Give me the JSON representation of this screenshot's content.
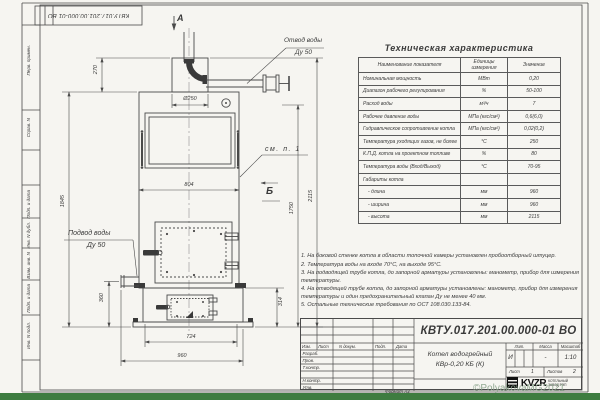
{
  "meta": {
    "stamp_rotated": "КВТУ.017.201.00.000-01 ВО",
    "format_label": "Формат А3",
    "watermark": "©PolyakovaMG2021",
    "colors": {
      "footer_green": "#3e7c40",
      "paper": "#f6f5f1",
      "line": "#4a4a4a"
    }
  },
  "frame_fields": [
    "Перв. примен.",
    "Справ. N",
    "Подп. и дата",
    "Инв. N дубл.",
    "Взам. инв. N",
    "Подп. и дата",
    "Инв. N подл."
  ],
  "drawing": {
    "section_a": "А",
    "view_b": "Б",
    "see_note": "см. п. 1",
    "outlet_label_1": "Отвод воды",
    "outlet_label_2": "Ду 50",
    "inlet_label_1": "Подвод воды",
    "inlet_label_2": "Ду 50",
    "dims": {
      "d270": "270",
      "d250": "Ø250",
      "d804": "804",
      "d1845": "1845",
      "d360": "360",
      "d724": "724",
      "d960": "960",
      "d314": "314",
      "d1750": "1750",
      "d2115": "2115"
    }
  },
  "spec_table": {
    "title": "Техническая характеристика",
    "headers": [
      "Наименование показателя",
      "Единицы измерения",
      "Значение"
    ],
    "rows": [
      {
        "name": "Номинальная мощность",
        "unit": "МВт",
        "value": "0,20"
      },
      {
        "name": "Диапазон рабочего регулирования",
        "unit": "%",
        "value": "50-100"
      },
      {
        "name": "Расход воды",
        "unit": "м³/ч",
        "value": "7"
      },
      {
        "name": "Рабочее давление воды",
        "unit": "МПа (кгс/см²)",
        "value": "0,6(6,0)"
      },
      {
        "name": "Гидравлическое сопротивление котла",
        "unit": "МПа (кгс/см²)",
        "value": "0,02(0,2)"
      },
      {
        "name": "Температура уходящих газов, не более",
        "unit": "°С",
        "value": "250"
      },
      {
        "name": "К.П.Д. котла на проектном топливе",
        "unit": "%",
        "value": "80"
      },
      {
        "name": "Температура воды (Вход/Выход)",
        "unit": "°С",
        "value": "70-95"
      },
      {
        "name": "Габариты котла",
        "unit": "",
        "value": ""
      },
      {
        "name": "- длина",
        "unit": "мм",
        "value": "960"
      },
      {
        "name": "- ширина",
        "unit": "мм",
        "value": "960"
      },
      {
        "name": "- высота",
        "unit": "мм",
        "value": "2115"
      }
    ]
  },
  "notes": [
    "1. На боковой стенке котла в области топочной камеры установлен пробоотборный штуцер.",
    "2. Температура воды на входе 70°С, на выходе 95°С.",
    "3. На подводящей трубе котла, до запорной арматуры установлены: манометр, прибор для измерения температуры.",
    "4. На отводящей трубе котла, до запорной арматуры установлены: манометр, прибор для измерения температуры и один предохранительный клапан Ду не менее 40 мм.",
    "5. Остальные технические требования по ОСТ 108.030.133-84."
  ],
  "title_block": {
    "doc_number": "КВТУ.017.201.00.000-01 ВО",
    "product_title_1": "Котел водогрейный",
    "product_title_2": "КВр-0,20 КБ (К)",
    "header_cols": [
      "Изм.",
      "Лист",
      "N докум.",
      "Подп.",
      "Дата"
    ],
    "sign_rows": [
      "Разраб.",
      "Пров.",
      "Т.контр.",
      "",
      "Н.контр.",
      "Утв."
    ],
    "lit_label": "Лит.",
    "mass_label": "Масса",
    "scale_label": "Масштаб",
    "lit_value": "И",
    "mass_value": "-",
    "scale_value": "1:10",
    "sheet_label": "Лист",
    "sheet_value": "1",
    "sheets_label": "Листов",
    "sheets_value": "2",
    "logo_text": "KVZR",
    "logo_sub_1": "КОТЕЛЬНЫЙ",
    "logo_sub_2": "ЗАВОД РЭП"
  }
}
